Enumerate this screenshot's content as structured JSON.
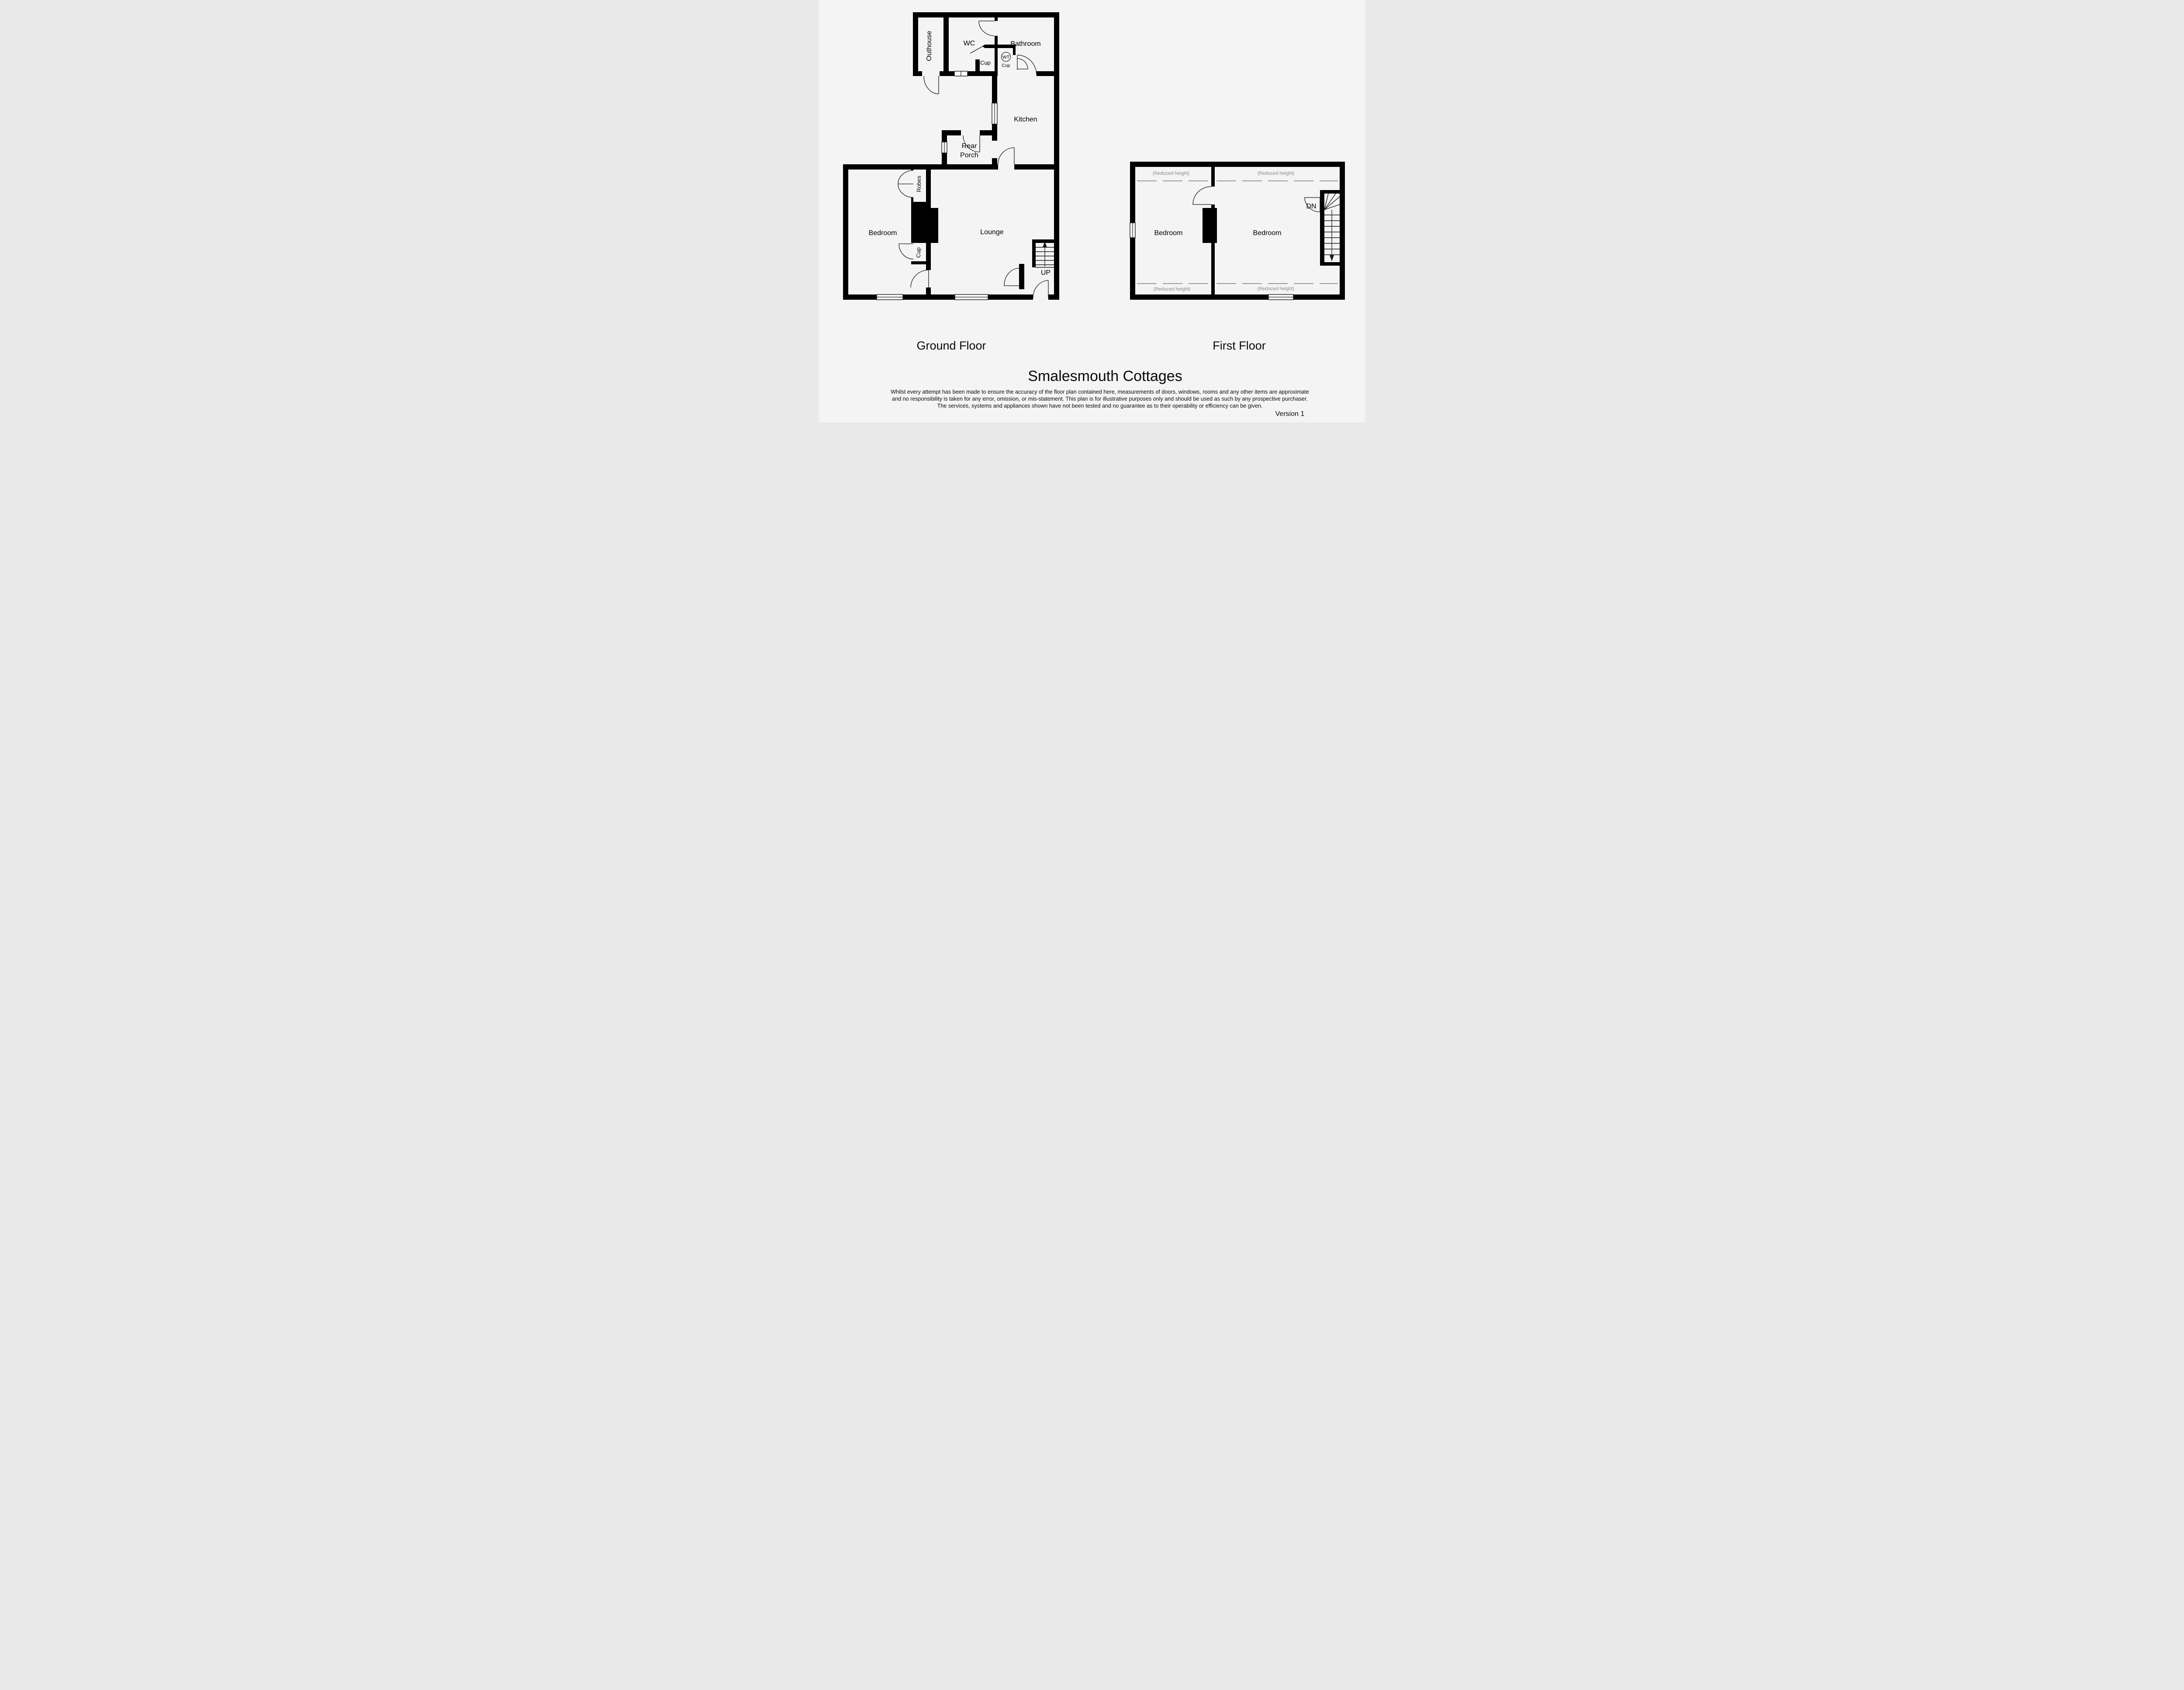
{
  "colors": {
    "background": "#f4f4f4",
    "wall": "#000000",
    "door_stroke": "#1a1a1a",
    "reduced_height_text": "#8a8a8a",
    "reduced_height_dash": "#999999"
  },
  "ground_floor": {
    "title": "Ground Floor",
    "rooms": {
      "outhouse": "Outhouse",
      "wc": "WC",
      "wc_cup": "Cup",
      "bathroom": "Bathroom",
      "wt": "WT",
      "wt_cup": "Cup",
      "kitchen": "Kitchen",
      "rear_porch_line1": "Rear",
      "rear_porch_line2": "Porch",
      "bedroom": "Bedroom",
      "robes": "Robes",
      "bedroom_cup": "Cup",
      "lounge": "Lounge",
      "stairs_direction": "UP"
    }
  },
  "first_floor": {
    "title": "First Floor",
    "rooms": {
      "bedroom_left": "Bedroom",
      "bedroom_right": "Bedroom",
      "stairs_direction": "DN"
    },
    "reduced_height_note": "(Reduced height)"
  },
  "footer": {
    "plan_title": "Smalesmouth Cottages",
    "disclaimer": [
      "Whilst every attempt has been made to ensure the accuracy of the floor plan contained here, measurements of doors, windows, rooms and any other items are approximate",
      "and no responsibility is taken for any error, omission, or mis-statement. This plan is for illustrative purposes only and should be used as such by any prospective purchaser.",
      "The services, systems and appliances shown have not been tested and no guarantee as to their operability or efficiency can be given."
    ],
    "version": "Version 1"
  }
}
